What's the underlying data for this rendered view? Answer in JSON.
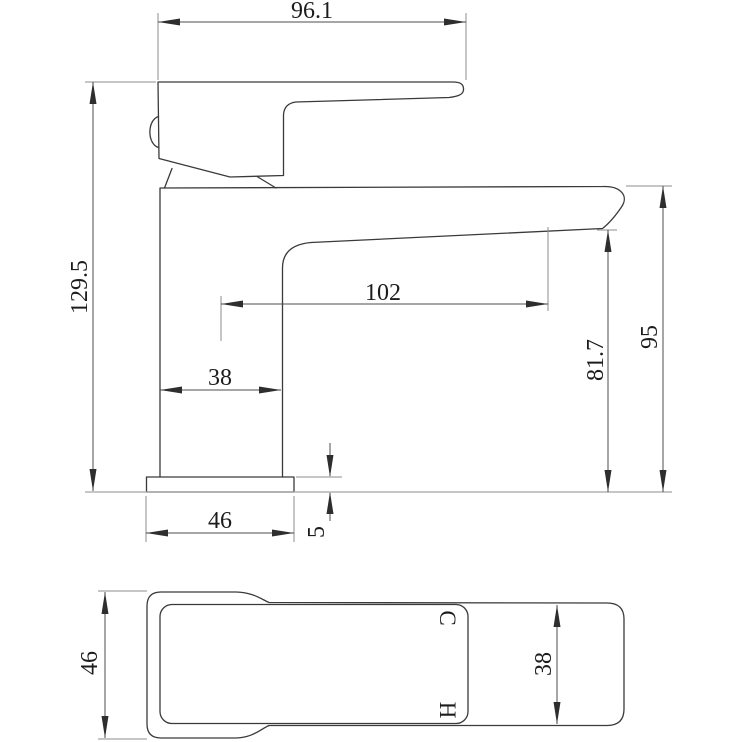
{
  "drawing": {
    "type": "faucet-technical-drawing",
    "units": "mm",
    "colors": {
      "line": "#3a3a3a",
      "dimension_line": "#4d4d4d",
      "extension_line": "#8c8c8c",
      "counter_line": "#a3a3a3",
      "background": "#ffffff"
    },
    "side_view": {
      "dim_width_top": "96.1",
      "dim_height_left": "129.5",
      "dim_spout_reach": "102",
      "dim_body_width": "38",
      "dim_base_width": "46",
      "dim_base_thickness": "5",
      "dim_outlet_height": "81.7",
      "dim_spout_height": "95"
    },
    "bottom_view": {
      "dim_base_depth": "46",
      "dim_body_depth": "38",
      "cold_label": "C",
      "hot_label": "H"
    }
  }
}
